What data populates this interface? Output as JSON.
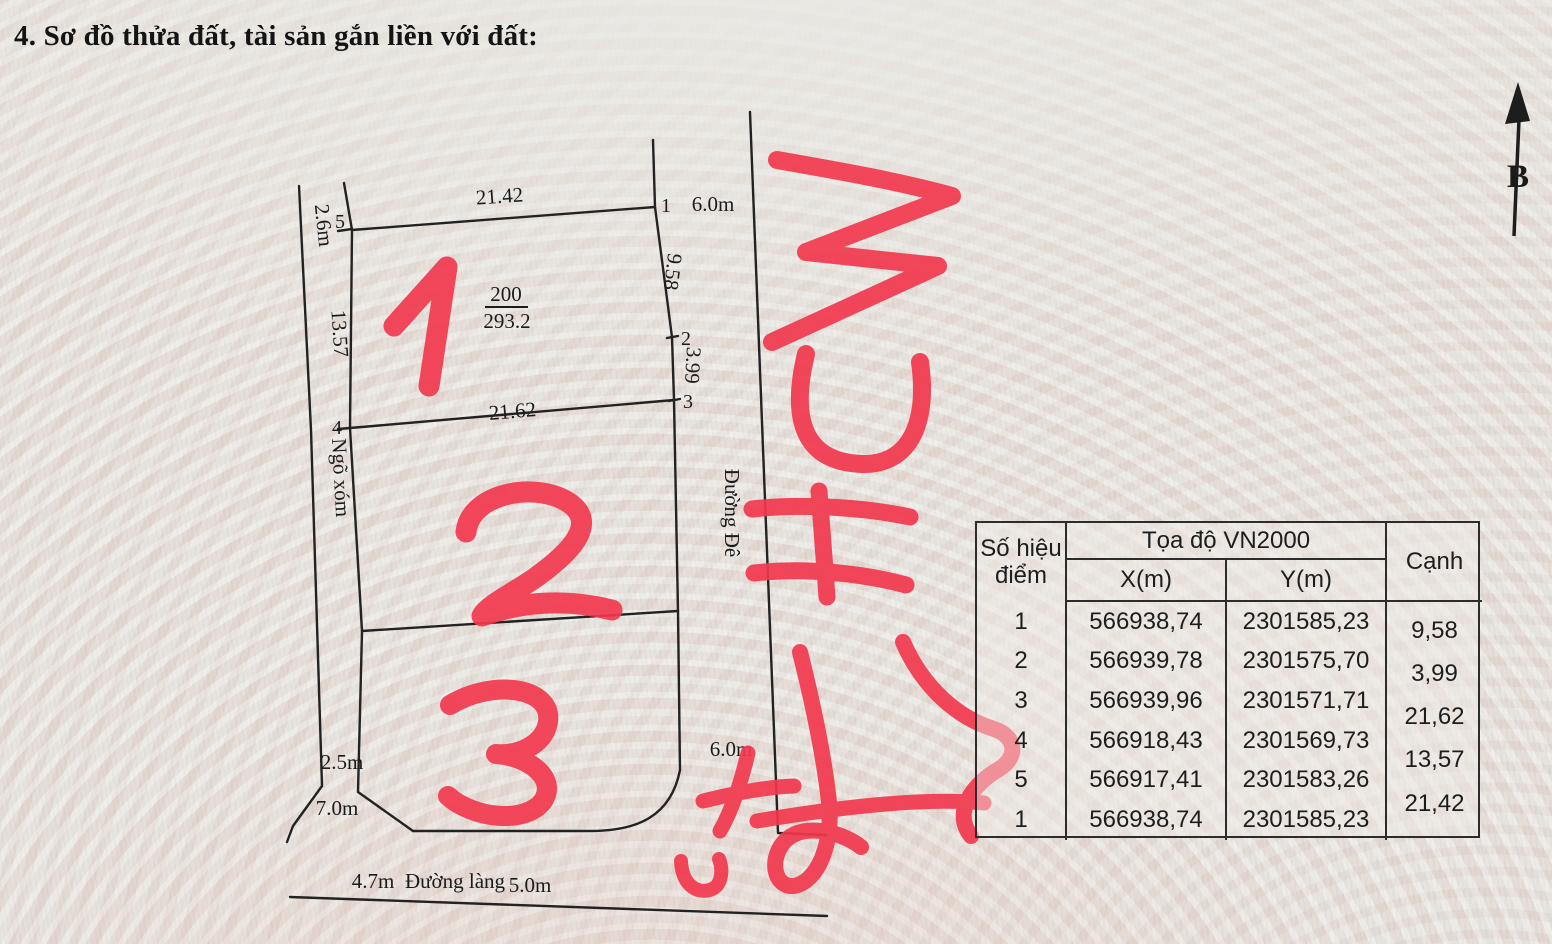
{
  "title": "4. Sơ đồ thửa đất, tài sản gắn liền với đất:",
  "compass": {
    "north_label": "B"
  },
  "diagram": {
    "parcel": {
      "number": "200",
      "area": "293.2"
    },
    "points": {
      "p1": "1",
      "p2": "2",
      "p3": "3",
      "p4": "4",
      "p5": "5"
    },
    "dims": {
      "top": "21.42",
      "middle": "21.62",
      "left": "13.57",
      "right_upper": "9.58",
      "right_lower": "3.99"
    },
    "widths": {
      "alley_top": "2.6m",
      "road_right_top": "6.0m",
      "road_right_bottom": "6.0m",
      "alley_bottom": "2.5m",
      "bottom_diagonal": "7.0m",
      "road_bottom_left": "4.7m",
      "road_bottom_right": "5.0m"
    },
    "names": {
      "alley": "Ngõ xóm",
      "road_right": "Đường Đê",
      "road_bottom": "Đường làng"
    },
    "red_marks": {
      "mark1": "1",
      "mark2": "2",
      "mark3": "3",
      "script": "HCM"
    }
  },
  "table": {
    "header": {
      "point": "Số hiệu điểm",
      "coords": "Tọa độ VN2000",
      "x": "X(m)",
      "y": "Y(m)",
      "edge": "Cạnh"
    },
    "rows": [
      {
        "point": "1",
        "x": "566938,74",
        "y": "2301585,23"
      },
      {
        "point": "2",
        "x": "566939,78",
        "y": "2301575,70"
      },
      {
        "point": "3",
        "x": "566939,96",
        "y": "2301571,71"
      },
      {
        "point": "4",
        "x": "566918,43",
        "y": "2301569,73"
      },
      {
        "point": "5",
        "x": "566917,41",
        "y": "2301583,26"
      },
      {
        "point": "1",
        "x": "566938,74",
        "y": "2301585,23"
      }
    ],
    "edges": [
      "9,58",
      "3,99",
      "21,62",
      "13,57",
      "21,42"
    ]
  }
}
